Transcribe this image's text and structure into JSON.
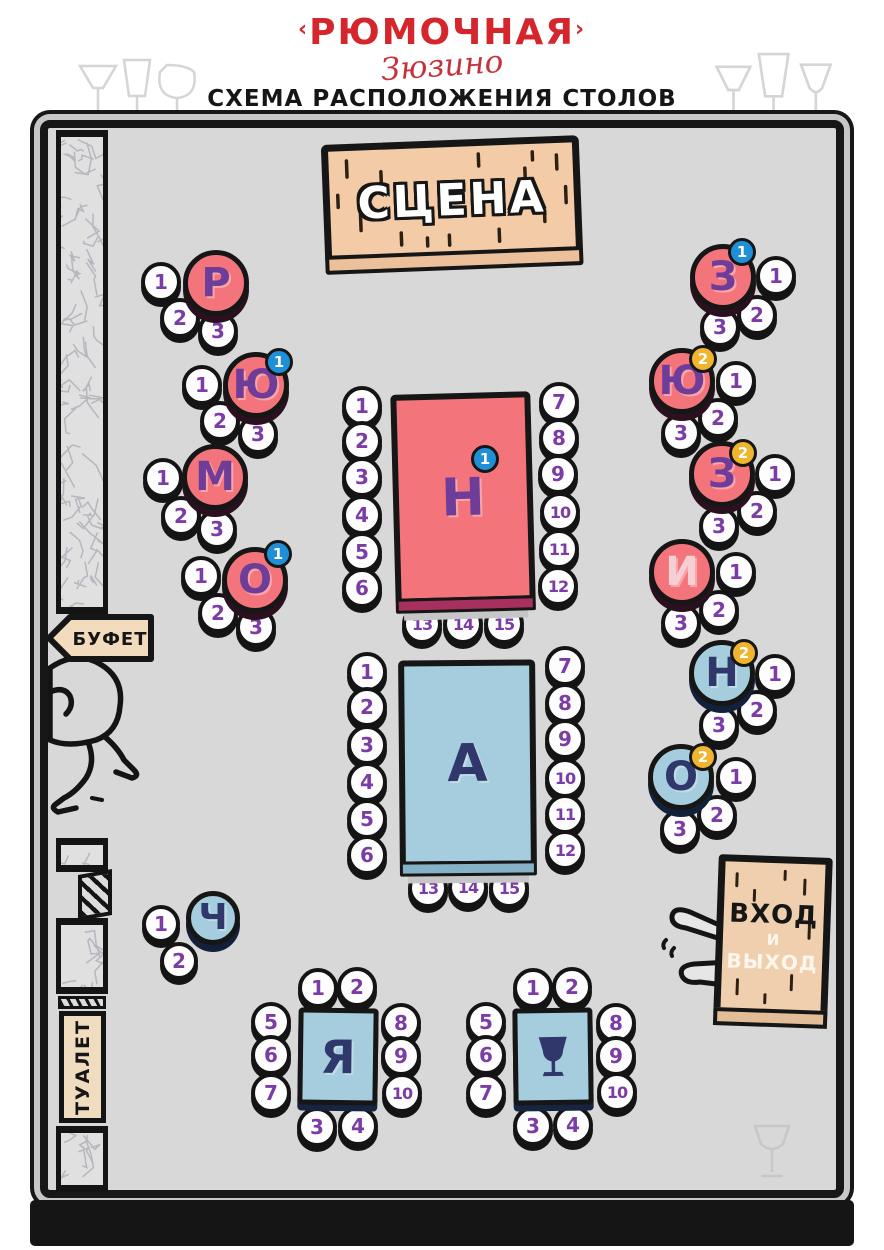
{
  "header": {
    "brand": "РЮМОЧНАЯ",
    "brand_left_mark": "‹",
    "brand_right_mark": "›",
    "script": "Зюзино",
    "subtitle": "СХЕМА РАСПОЛОЖЕНИЯ СТОЛОВ"
  },
  "stage": {
    "label": "СЦЕНА"
  },
  "signs": {
    "buffet": {
      "label": "БУФЕТ"
    },
    "toilet": {
      "label": "ТУАЛЕТ"
    },
    "entrance": {
      "line1": "ВХОД",
      "line2": "И",
      "line3": "ВЫХОД"
    }
  },
  "colors": {
    "floor": "#d8d8d8",
    "outline": "#161616",
    "table_red": "#f4747c",
    "table_red_face": "#a8305f",
    "table_blue": "#a5cddd",
    "table_blue_face": "#85b2c6",
    "letter_purple": "#6e3d99",
    "letter_navy": "#2f376b",
    "seat_number": "#7b3ca6",
    "badge_blue": "#1f90d8",
    "badge_yellow": "#f0b42d",
    "wood": "#f3cba6",
    "brand_red": "#d5262e"
  },
  "tables": [
    {
      "id": "r",
      "label": "Р",
      "shape": "round",
      "palette": "red",
      "cx": 216,
      "cy": 283,
      "r": 33,
      "seats": [
        {
          "n": "1",
          "cx": 161,
          "cy": 282
        },
        {
          "n": "2",
          "cx": 180,
          "cy": 318
        },
        {
          "n": "3",
          "cx": 218,
          "cy": 331
        }
      ]
    },
    {
      "id": "yu-1",
      "label": "Ю",
      "shape": "round",
      "palette": "red",
      "cx": 256,
      "cy": 385,
      "r": 33,
      "badge": {
        "value": "1",
        "color": "blue",
        "cx": 279,
        "cy": 362
      },
      "seats": [
        {
          "n": "1",
          "cx": 202,
          "cy": 385
        },
        {
          "n": "2",
          "cx": 220,
          "cy": 421
        },
        {
          "n": "3",
          "cx": 258,
          "cy": 434
        }
      ]
    },
    {
      "id": "m",
      "label": "М",
      "shape": "round",
      "palette": "red",
      "cx": 215,
      "cy": 477,
      "r": 33,
      "seats": [
        {
          "n": "1",
          "cx": 163,
          "cy": 478
        },
        {
          "n": "2",
          "cx": 181,
          "cy": 516
        },
        {
          "n": "3",
          "cx": 217,
          "cy": 529
        }
      ]
    },
    {
      "id": "o-1",
      "label": "О",
      "shape": "round",
      "palette": "red",
      "cx": 255,
      "cy": 580,
      "r": 33,
      "badge": {
        "value": "1",
        "color": "blue",
        "cx": 278,
        "cy": 554
      },
      "seats": [
        {
          "n": "1",
          "cx": 201,
          "cy": 576
        },
        {
          "n": "2",
          "cx": 218,
          "cy": 613
        },
        {
          "n": "3",
          "cx": 256,
          "cy": 627
        }
      ]
    },
    {
      "id": "z-1",
      "label": "З",
      "shape": "round",
      "palette": "red",
      "cx": 723,
      "cy": 277,
      "r": 33,
      "badge": {
        "value": "1",
        "color": "blue",
        "cx": 742,
        "cy": 252
      },
      "seats": [
        {
          "n": "1",
          "cx": 776,
          "cy": 276
        },
        {
          "n": "2",
          "cx": 757,
          "cy": 315
        },
        {
          "n": "3",
          "cx": 720,
          "cy": 327
        }
      ]
    },
    {
      "id": "yu-2",
      "label": "Ю",
      "shape": "round",
      "palette": "red",
      "cx": 682,
      "cy": 381,
      "r": 33,
      "badge": {
        "value": "2",
        "color": "yellow",
        "cx": 703,
        "cy": 359
      },
      "seats": [
        {
          "n": "1",
          "cx": 736,
          "cy": 381
        },
        {
          "n": "2",
          "cx": 718,
          "cy": 418
        },
        {
          "n": "3",
          "cx": 681,
          "cy": 433
        }
      ]
    },
    {
      "id": "z-2",
      "label": "З",
      "shape": "round",
      "palette": "red",
      "cx": 722,
      "cy": 474,
      "r": 33,
      "badge": {
        "value": "2",
        "color": "yellow",
        "cx": 743,
        "cy": 453
      },
      "seats": [
        {
          "n": "1",
          "cx": 775,
          "cy": 474
        },
        {
          "n": "2",
          "cx": 757,
          "cy": 511
        },
        {
          "n": "3",
          "cx": 719,
          "cy": 526
        }
      ]
    },
    {
      "id": "i",
      "label": "И",
      "shape": "round",
      "palette": "red",
      "label_color": "#f6ced4",
      "cx": 682,
      "cy": 572,
      "r": 33,
      "seats": [
        {
          "n": "1",
          "cx": 736,
          "cy": 572
        },
        {
          "n": "2",
          "cx": 719,
          "cy": 610
        },
        {
          "n": "3",
          "cx": 681,
          "cy": 623
        }
      ]
    },
    {
      "id": "n-2",
      "label": "Н",
      "shape": "round",
      "palette": "blue",
      "cx": 722,
      "cy": 673,
      "r": 33,
      "badge": {
        "value": "2",
        "color": "yellow",
        "cx": 744,
        "cy": 653
      },
      "seats": [
        {
          "n": "1",
          "cx": 775,
          "cy": 674
        },
        {
          "n": "2",
          "cx": 757,
          "cy": 710
        },
        {
          "n": "3",
          "cx": 719,
          "cy": 725
        }
      ]
    },
    {
      "id": "o-2",
      "label": "О",
      "shape": "round",
      "palette": "blue",
      "cx": 681,
      "cy": 777,
      "r": 33,
      "badge": {
        "value": "2",
        "color": "yellow",
        "cx": 703,
        "cy": 757
      },
      "seats": [
        {
          "n": "1",
          "cx": 736,
          "cy": 777
        },
        {
          "n": "2",
          "cx": 717,
          "cy": 815
        },
        {
          "n": "3",
          "cx": 680,
          "cy": 829
        }
      ]
    },
    {
      "id": "ch",
      "label": "Ч",
      "shape": "round",
      "palette": "blue",
      "cx": 213,
      "cy": 918,
      "r": 27,
      "seat_r": 19,
      "seats": [
        {
          "n": "1",
          "cx": 161,
          "cy": 924
        },
        {
          "n": "2",
          "cx": 179,
          "cy": 961
        }
      ]
    },
    {
      "id": "n-1",
      "label": "Н",
      "shape": "rect",
      "palette": "red",
      "x": 393,
      "y": 393,
      "w": 140,
      "h": 210,
      "rotate": -1.5,
      "seat_r": 20,
      "badge": {
        "value": "1",
        "color": "blue",
        "cx": 485,
        "cy": 459
      },
      "seats": [
        {
          "n": "1",
          "cx": 362,
          "cy": 406
        },
        {
          "n": "2",
          "cx": 362,
          "cy": 441
        },
        {
          "n": "3",
          "cx": 362,
          "cy": 477
        },
        {
          "n": "4",
          "cx": 362,
          "cy": 515
        },
        {
          "n": "5",
          "cx": 362,
          "cy": 552
        },
        {
          "n": "6",
          "cx": 362,
          "cy": 588
        },
        {
          "n": "7",
          "cx": 559,
          "cy": 402
        },
        {
          "n": "8",
          "cx": 559,
          "cy": 438
        },
        {
          "n": "9",
          "cx": 558,
          "cy": 474
        },
        {
          "n": "10",
          "cx": 560,
          "cy": 512
        },
        {
          "n": "11",
          "cx": 559,
          "cy": 549
        },
        {
          "n": "12",
          "cx": 558,
          "cy": 586
        },
        {
          "n": "13",
          "cx": 422,
          "cy": 624
        },
        {
          "n": "14",
          "cx": 463,
          "cy": 624
        },
        {
          "n": "15",
          "cx": 504,
          "cy": 624
        }
      ]
    },
    {
      "id": "a",
      "label": "А",
      "shape": "rect",
      "palette": "blue",
      "x": 399,
      "y": 660,
      "w": 137,
      "h": 207,
      "rotate": -0.5,
      "seat_r": 20,
      "seats": [
        {
          "n": "1",
          "cx": 367,
          "cy": 672
        },
        {
          "n": "2",
          "cx": 367,
          "cy": 707
        },
        {
          "n": "3",
          "cx": 367,
          "cy": 745
        },
        {
          "n": "4",
          "cx": 367,
          "cy": 782
        },
        {
          "n": "5",
          "cx": 367,
          "cy": 819
        },
        {
          "n": "6",
          "cx": 367,
          "cy": 855
        },
        {
          "n": "7",
          "cx": 565,
          "cy": 666
        },
        {
          "n": "8",
          "cx": 565,
          "cy": 703
        },
        {
          "n": "9",
          "cx": 565,
          "cy": 739
        },
        {
          "n": "10",
          "cx": 565,
          "cy": 778
        },
        {
          "n": "11",
          "cx": 565,
          "cy": 814
        },
        {
          "n": "12",
          "cx": 565,
          "cy": 850
        },
        {
          "n": "13",
          "cx": 428,
          "cy": 888
        },
        {
          "n": "14",
          "cx": 468,
          "cy": 887
        },
        {
          "n": "15",
          "cx": 509,
          "cy": 888
        }
      ]
    },
    {
      "id": "ya",
      "label": "Я",
      "shape": "square",
      "palette": "blue",
      "x": 298,
      "y": 1008,
      "w": 80,
      "h": 97,
      "rotate": 0.8,
      "seats": [
        {
          "n": "1",
          "cx": 318,
          "cy": 988
        },
        {
          "n": "2",
          "cx": 357,
          "cy": 987
        },
        {
          "n": "5",
          "cx": 271,
          "cy": 1022
        },
        {
          "n": "6",
          "cx": 271,
          "cy": 1055
        },
        {
          "n": "7",
          "cx": 271,
          "cy": 1093
        },
        {
          "n": "8",
          "cx": 401,
          "cy": 1023
        },
        {
          "n": "9",
          "cx": 401,
          "cy": 1056
        },
        {
          "n": "10",
          "cx": 402,
          "cy": 1093
        },
        {
          "n": "3",
          "cx": 317,
          "cy": 1127
        },
        {
          "n": "4",
          "cx": 358,
          "cy": 1126
        }
      ]
    },
    {
      "id": "glass",
      "icon": "glass",
      "shape": "square",
      "palette": "blue",
      "x": 513,
      "y": 1008,
      "w": 80,
      "h": 97,
      "rotate": -0.8,
      "seats": [
        {
          "n": "1",
          "cx": 533,
          "cy": 988
        },
        {
          "n": "2",
          "cx": 572,
          "cy": 987
        },
        {
          "n": "5",
          "cx": 486,
          "cy": 1022
        },
        {
          "n": "6",
          "cx": 486,
          "cy": 1055
        },
        {
          "n": "7",
          "cx": 486,
          "cy": 1093
        },
        {
          "n": "8",
          "cx": 616,
          "cy": 1023
        },
        {
          "n": "9",
          "cx": 616,
          "cy": 1056
        },
        {
          "n": "10",
          "cx": 617,
          "cy": 1092
        },
        {
          "n": "3",
          "cx": 533,
          "cy": 1126
        },
        {
          "n": "4",
          "cx": 573,
          "cy": 1125
        }
      ]
    }
  ]
}
